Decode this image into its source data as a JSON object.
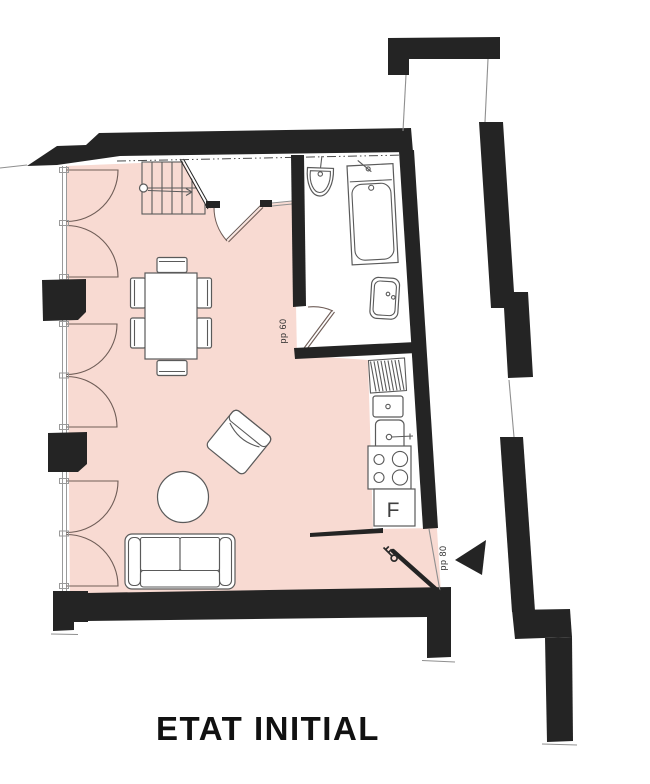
{
  "title": "ETAT INITIAL",
  "labels": {
    "bathroom_door": "pp 60",
    "entrance_door": "pp 80",
    "fridge": "F"
  },
  "colors": {
    "background": "#ffffff",
    "floor": "#f8dad2",
    "wall": "#242424",
    "furniture_line": "#5a5a5a",
    "door_line": "#6f5d57",
    "label_text": "#2e2e2e",
    "title_text": "#111111"
  }
}
